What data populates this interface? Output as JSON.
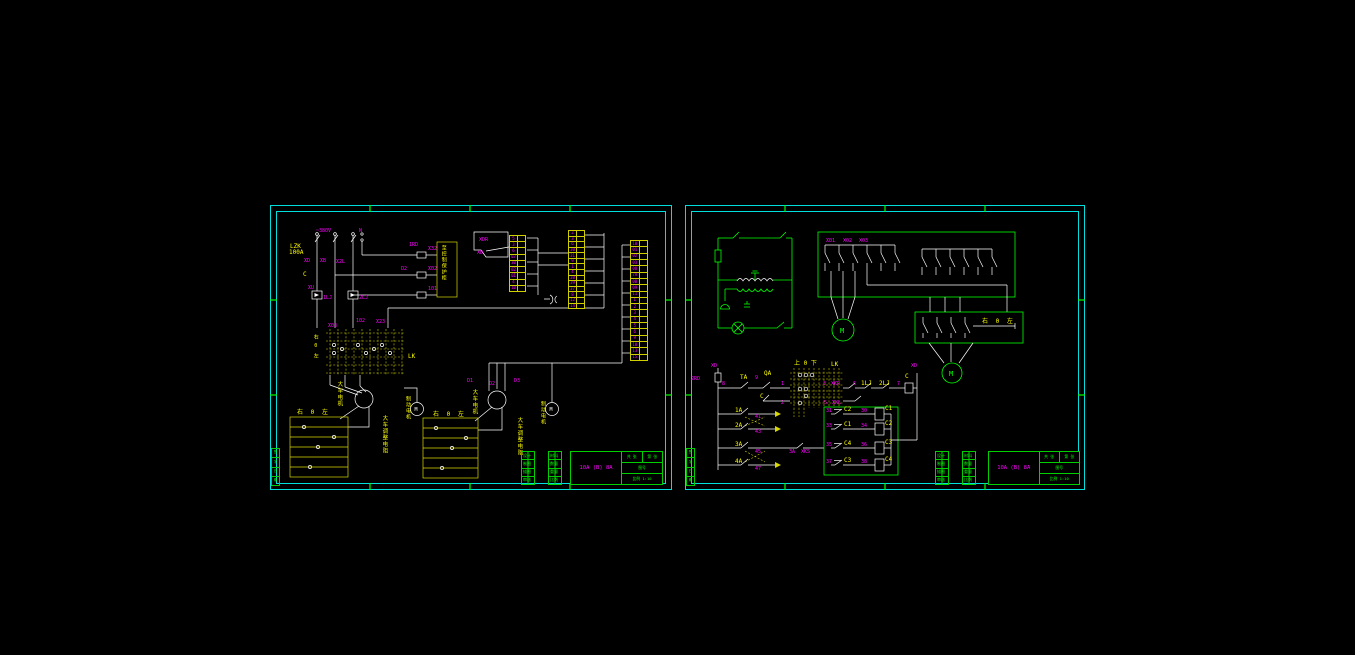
{
  "colors": {
    "background": "#000000",
    "frame_cyan": "#00dede",
    "wire_white": "#ffffff",
    "component_green": "#00ff00",
    "annotation_yellow": "#ffff00",
    "label_magenta": "#ff00ff"
  },
  "sheet1": {
    "power": {
      "voltage": "~380V",
      "neutral": "N",
      "breaker": "LZK",
      "rating": "100A",
      "pole1": "XD",
      "pole2": "XB",
      "pole3": "X2L",
      "c": "C",
      "xu": "XU",
      "relay1": "1LJ",
      "relay2": "2LJ"
    },
    "fuse_row": {
      "f1": "1RD",
      "f2": "D2",
      "w1": "X32",
      "w2": "X02",
      "w3": "101"
    },
    "outgoing_box_label": "至控制保护柜",
    "junction": {
      "a": "XDR",
      "b": "XD"
    },
    "mid": {
      "a": "X03",
      "b": "102",
      "c": "X23"
    },
    "lk": {
      "name": "LK",
      "positions": "右0左"
    },
    "motor1": {
      "name": "大车电机",
      "brake": "制动电机",
      "m": "M"
    },
    "motor2": {
      "name": "大车电机",
      "brake": "制动电机",
      "m": "M",
      "t1": "D1",
      "t2": "D2",
      "t3": "D3"
    },
    "res1": {
      "header": "右 0 左",
      "label": "大车调整电阻"
    },
    "res2": {
      "header": "右 0 左",
      "label": "大车调整电阻"
    },
    "strips": {
      "ts1": [
        "5",
        "3",
        "6",
        "07",
        "30",
        "02",
        "01",
        "4",
        "10"
      ],
      "ts2": [
        "2",
        "3",
        "6",
        "30",
        "31",
        "9",
        "1",
        "4",
        "38",
        "39",
        "37",
        "8",
        "12",
        "14"
      ],
      "ts3": [
        "10",
        "01",
        "02",
        "03",
        "08",
        "7A",
        "0B",
        "09",
        "11",
        "1",
        "2",
        "3",
        "4",
        "5",
        "6",
        "9",
        "10",
        "13",
        "15"
      ]
    }
  },
  "sheet2": {
    "box_labels": {
      "a": "X01",
      "b": "X02",
      "c": "X03"
    },
    "motor_main": "M",
    "motor_aux": "M",
    "aux_header": "右 0 左",
    "ctrl": {
      "xd_left": "XD",
      "fuse": "2RD",
      "n8": "8",
      "ta": "TA",
      "n9": "9",
      "qa": "QA",
      "n1": "1",
      "c_sw": "C",
      "n2": "2",
      "lk": "LK",
      "lk_header": "上 0 下",
      "n3": "3",
      "xkr": "XKR",
      "n6": "6",
      "lj1": "1LJ",
      "lj2": "2LJ",
      "n7": "7",
      "c_coil": "C",
      "xd_right": "XD",
      "n5": "5",
      "xkl": "XKL",
      "sw1": "1A",
      "w1": "41",
      "sw2": "2A",
      "w2": "43",
      "sw3": "3A",
      "w3": "45",
      "sw4": "4A",
      "w4": "47",
      "r3a": "3A",
      "r3b": "XKS",
      "relays": {
        "l1": "31",
        "k1": "C2",
        "r1": "30",
        "coil1": "C1",
        "l2": "33",
        "k2": "C1",
        "r2": "34",
        "coil2": "C2",
        "l3": "35",
        "k3": "C4",
        "r3": "36",
        "coil3": "C3",
        "l4": "37",
        "k4": "C3",
        "r4": "38",
        "coil4": "C4"
      }
    }
  },
  "titleblock": {
    "doc_no": "10A (B) 8A",
    "strip1": [
      "设计",
      "制图",
      "描图",
      "审核"
    ],
    "strip2": [
      "材料",
      "数量",
      "重量",
      "比例"
    ],
    "r1a": "共 张",
    "r1b": "第 张",
    "r2": "图号",
    "r3": "比例 1:10",
    "margin": [
      "签",
      "字",
      "日",
      "期"
    ]
  }
}
